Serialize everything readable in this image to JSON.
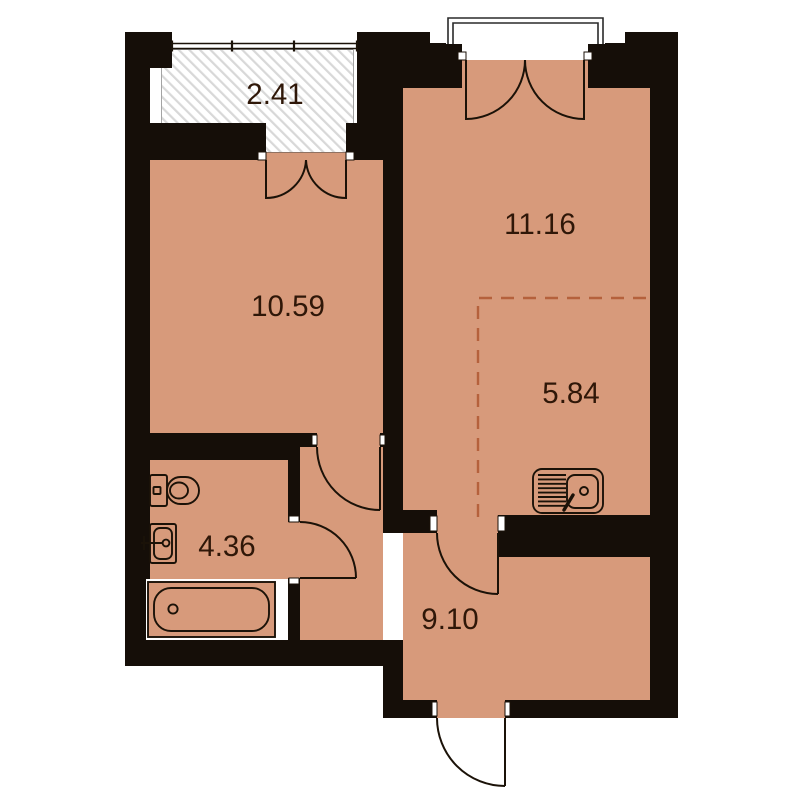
{
  "floor_plan": {
    "rooms": [
      {
        "key": "balcony",
        "area": "2.41"
      },
      {
        "key": "living-room",
        "area": "11.16"
      },
      {
        "key": "bedroom",
        "area": "10.59"
      },
      {
        "key": "kitchen-niche",
        "area": "5.84"
      },
      {
        "key": "bathroom",
        "area": "4.36"
      },
      {
        "key": "hallway",
        "area": "9.10"
      }
    ],
    "colors": {
      "floor": "#d79a7b",
      "wall": "#150e08",
      "line": "#1b1208",
      "dash": "#b5613c",
      "label": "#2f1708",
      "hatch": "#d8d8d8",
      "background": "#ffffff"
    }
  }
}
